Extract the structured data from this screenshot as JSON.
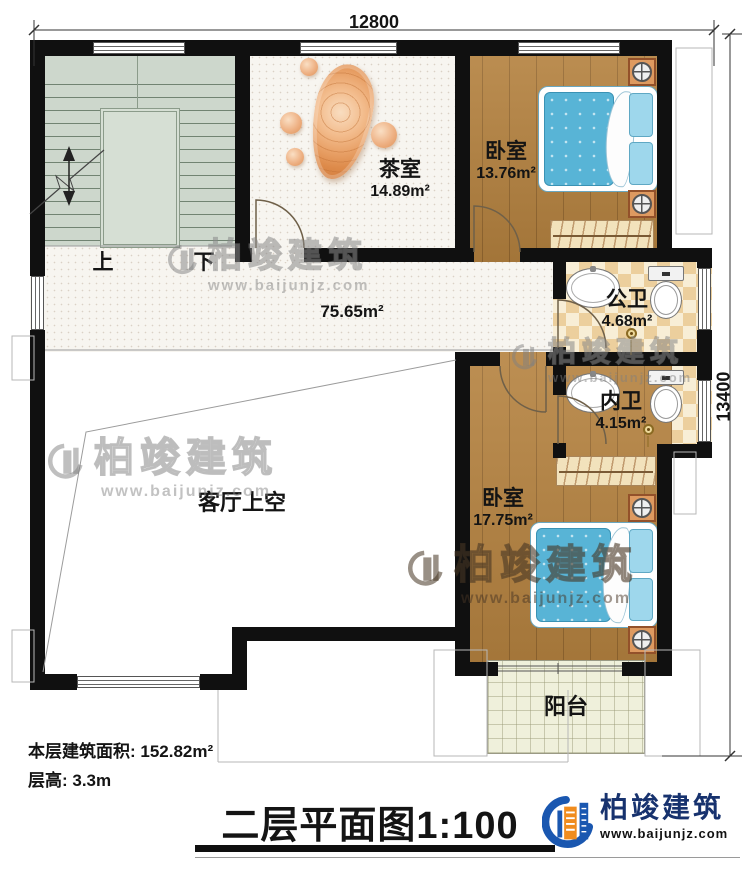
{
  "dimensions": {
    "width": "12800",
    "height": "13400"
  },
  "rooms": {
    "stairwell": {
      "up": "上",
      "down": "下"
    },
    "tea_room": {
      "name": "茶室",
      "area": "14.89m²"
    },
    "bedroom_top": {
      "name": "卧室",
      "area": "13.76m²"
    },
    "public_bathroom": {
      "name": "公卫",
      "area": "4.68m²"
    },
    "ensuite_bathroom": {
      "name": "内卫",
      "area": "4.15m²"
    },
    "bedroom_bottom": {
      "name": "卧室",
      "area": "17.75m²"
    },
    "hallway": {
      "area": "75.65m²"
    },
    "living_room_void": {
      "name": "客厅上空"
    },
    "balcony": {
      "name": "阳台"
    }
  },
  "footer": {
    "floor_area": "本层建筑面积: 152.82m²",
    "floor_height": "层高: 3.3m",
    "plan_title": "二层平面图",
    "plan_scale": "1:100"
  },
  "brand": {
    "name": "柏竣建筑",
    "website": "www.baijunjz.com"
  },
  "watermark": {
    "name": "柏竣建筑",
    "website": "www.baijunjz.com"
  },
  "colors": {
    "wall": "#101010",
    "wood": "#b5823f",
    "bed_blue": "#58b4d6",
    "tile_tan": "#eccf9d",
    "stair_green": "#cdd7cc",
    "brand_blue": "#1a57b0",
    "brand_orange": "#f08c1e"
  }
}
